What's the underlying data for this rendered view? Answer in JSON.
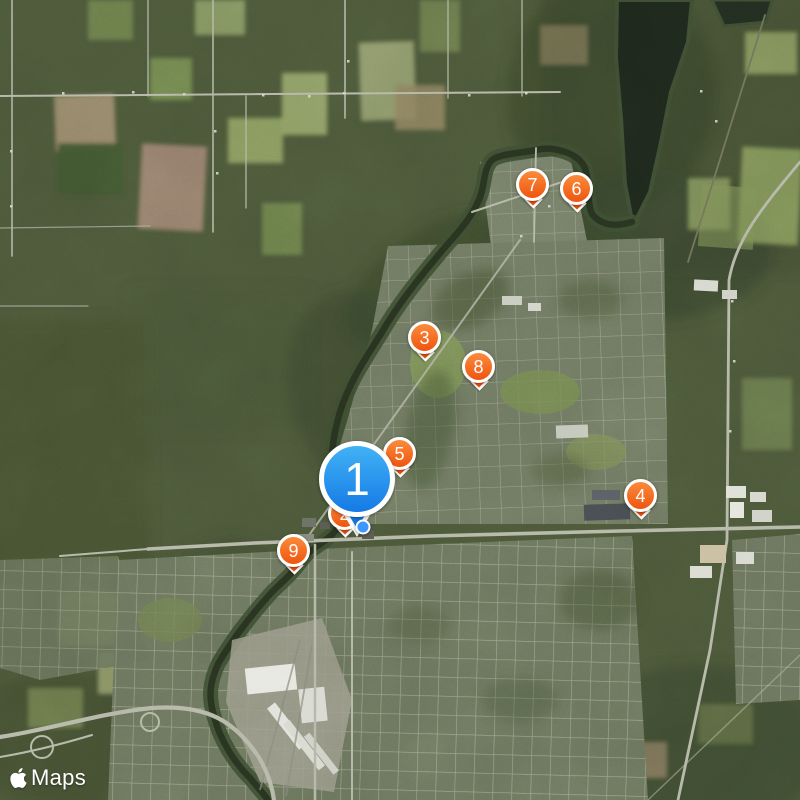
{
  "logo": {
    "wordmark": "Maps",
    "icon": "apple-logo"
  },
  "markers": [
    {
      "label": "7",
      "x": 533,
      "y": 185,
      "color": "orange",
      "size": "small"
    },
    {
      "label": "6",
      "x": 577,
      "y": 189,
      "color": "orange",
      "size": "small"
    },
    {
      "label": "3",
      "x": 425,
      "y": 338,
      "color": "orange",
      "size": "small"
    },
    {
      "label": "8",
      "x": 479,
      "y": 367,
      "color": "orange",
      "size": "small"
    },
    {
      "label": "5",
      "x": 400,
      "y": 454,
      "color": "orange",
      "size": "small"
    },
    {
      "label": "4",
      "x": 641,
      "y": 496,
      "color": "orange",
      "size": "small"
    },
    {
      "label": "9",
      "x": 294,
      "y": 551,
      "color": "orange",
      "size": "small"
    },
    {
      "label": "2",
      "x": 345,
      "y": 514,
      "color": "orange",
      "size": "small"
    },
    {
      "label": "1",
      "x": 357,
      "y": 479,
      "color": "blue",
      "size": "large"
    }
  ],
  "user_location": {
    "x": 363,
    "y": 527
  },
  "colors": {
    "pin_orange_top": "#fb8b3c",
    "pin_orange_bottom": "#ee5510",
    "pin_blue_top": "#41b2f5",
    "pin_blue_bottom": "#157ae6",
    "user_dot": "#3e97ff",
    "logo_text": "#ffffff"
  }
}
